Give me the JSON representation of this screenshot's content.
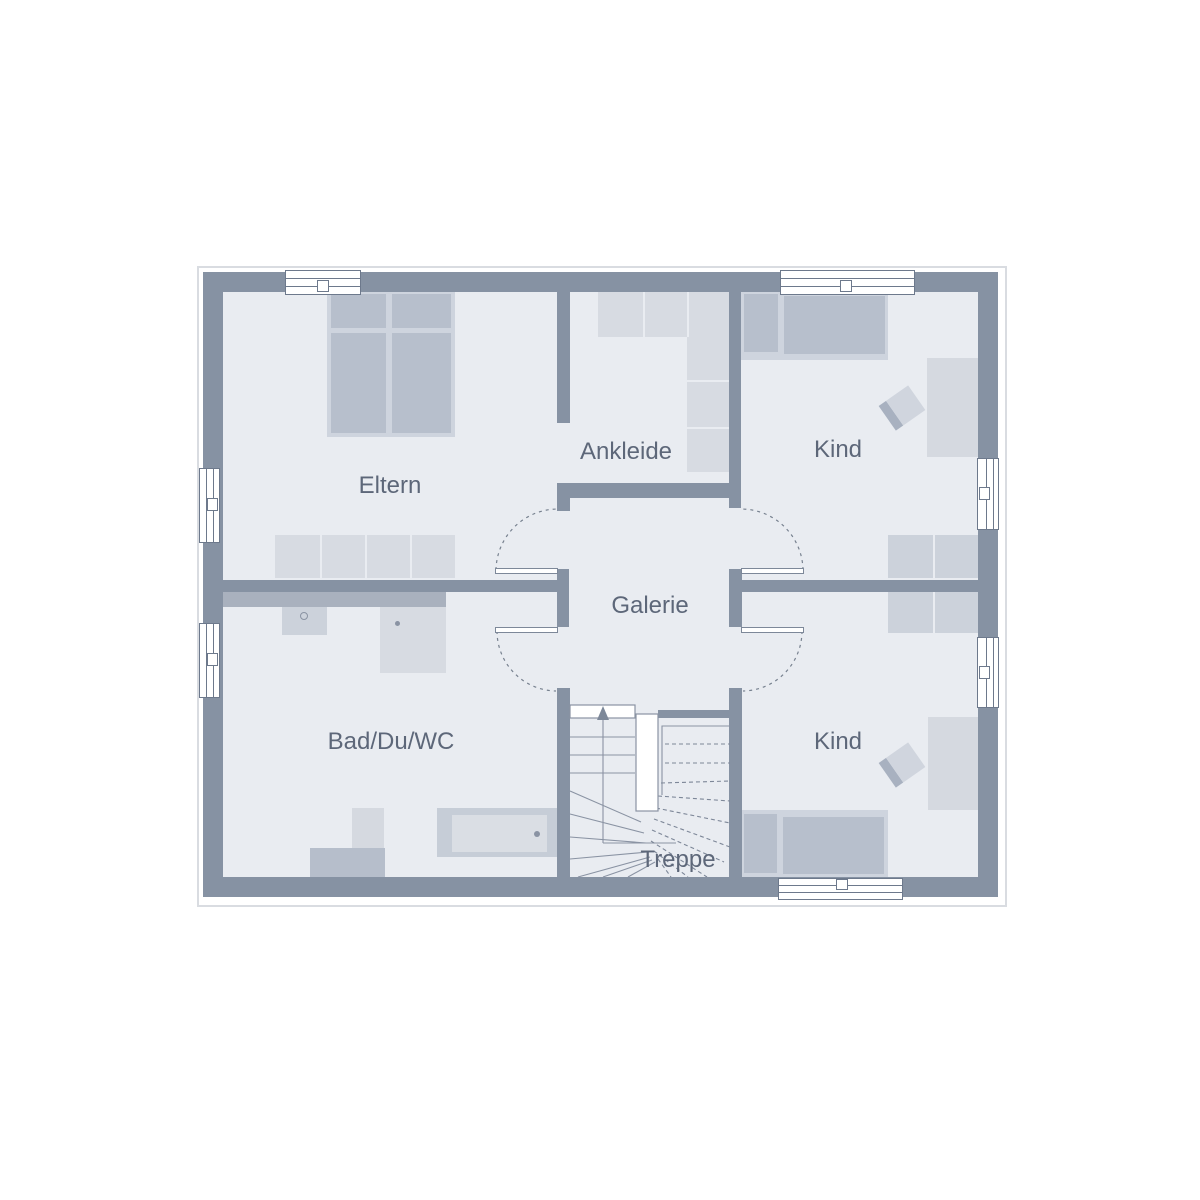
{
  "rooms": {
    "eltern": {
      "label": "Eltern"
    },
    "ankleide": {
      "label": "Ankleide"
    },
    "kind_top": {
      "label": "Kind"
    },
    "galerie": {
      "label": "Galerie"
    },
    "bad": {
      "label": "Bad/Du/WC"
    },
    "kind_bottom": {
      "label": "Kind"
    },
    "treppe": {
      "label": "Treppe"
    }
  },
  "colors": {
    "wall": "#8692a3",
    "floor": "#e9ecf1",
    "furn-mid": "#b7bfcc",
    "furn-frame": "#ced4de",
    "furn-light": "#d7dbe2",
    "wardrobe": "#ccd2db",
    "desk": "#d5d9e0",
    "counter": "#a9b1be",
    "pedestal": "#b6becb",
    "tub": "#c6cdd7",
    "tub-inner": "#dadee4",
    "chair-light": "#d0d5de",
    "chair-dark": "#a8b1c0",
    "line": "#8a93a3",
    "dash": "#7d8798",
    "text": "#5d6779",
    "window-border": "#6d798c",
    "leaf-border": "#7d8899",
    "roofline": "#d9dce1"
  }
}
